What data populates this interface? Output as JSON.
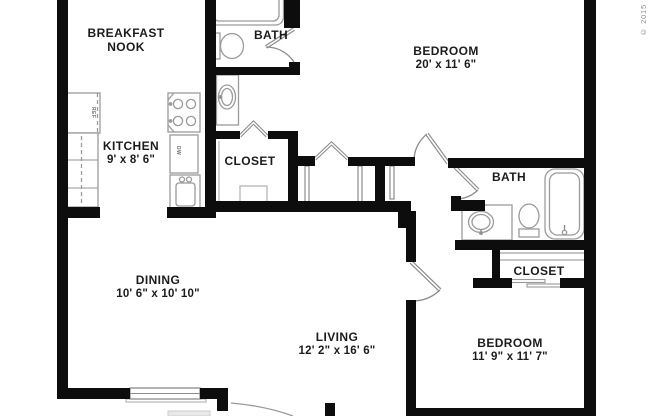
{
  "rooms": {
    "breakfast_nook": {
      "line1": "BREAKFAST",
      "line2": "NOOK"
    },
    "bath_top": {
      "name": "BATH"
    },
    "bedroom_top": {
      "name": "BEDROOM",
      "dims": "20' x 11' 6\""
    },
    "kitchen": {
      "name": "KITCHEN",
      "dims": "9' x 8' 6\""
    },
    "closet_hall": {
      "name": "CLOSET"
    },
    "bath_right": {
      "name": "BATH"
    },
    "dining": {
      "name": "DINING",
      "dims": "10' 6\" x 10' 10\""
    },
    "closet_bedroom": {
      "name": "CLOSET"
    },
    "living": {
      "name": "LIVING",
      "dims": "12' 2\" x 16' 6\""
    },
    "bedroom_bottom": {
      "name": "BEDROOM",
      "dims": "11' 9\" x 11' 7\""
    }
  },
  "appliances": {
    "refrigerator": "REF",
    "dishwasher": "DW"
  },
  "watermark": "© 2015"
}
